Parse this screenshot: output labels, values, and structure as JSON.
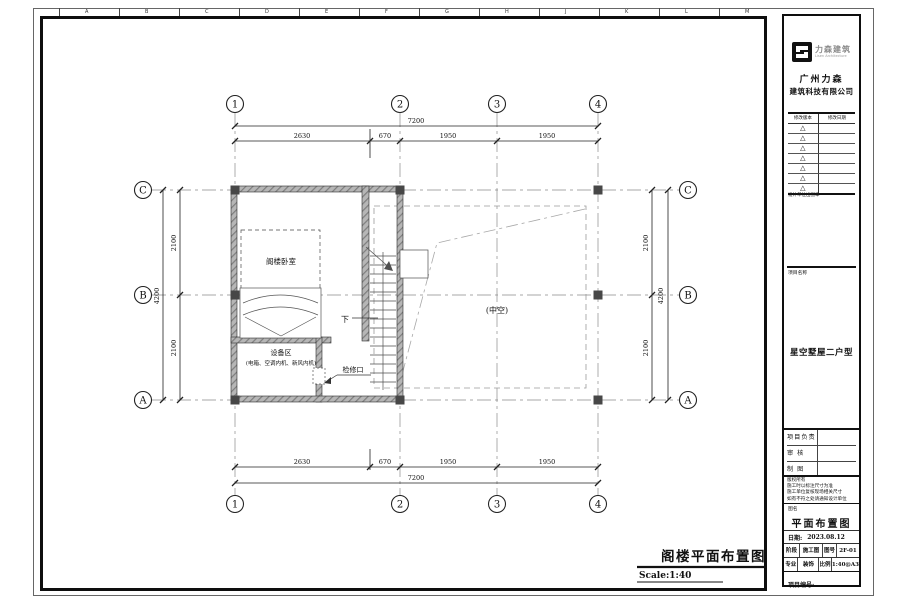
{
  "sheet": {
    "ruler_letters": [
      "A",
      "B",
      "C",
      "D",
      "E",
      "F",
      "G",
      "H",
      "J",
      "K",
      "L",
      "M"
    ],
    "drawing_title": "阁楼平面布置图",
    "drawing_scale": "Scale:1:40"
  },
  "plan": {
    "axes": {
      "cols": [
        "1",
        "2",
        "3",
        "4"
      ],
      "rows": [
        "C",
        "B",
        "A"
      ]
    },
    "dims": {
      "top_total": "7200",
      "top_segments": [
        "2630",
        "670",
        "1950",
        "1950"
      ],
      "bottom_total": "7200",
      "bottom_segments": [
        "2630",
        "670",
        "1950",
        "1950"
      ],
      "left_segments": [
        "2100",
        "2100"
      ],
      "left_total": "4200",
      "right_segments": [
        "2100",
        "2100"
      ],
      "right_total": "4200"
    },
    "labels": {
      "bedroom": "阁楼卧室",
      "equipment_title": "设备区",
      "equipment_detail": "(电箱、空调内机、新风内机)",
      "access": "检修口",
      "void": "(中空)",
      "down": "下"
    }
  },
  "titleblock": {
    "logo_text": "力森建筑",
    "logo_sub": "Lisen Architecture",
    "company_line1": "广州力森",
    "company_line2": "建筑科技有限公司",
    "revision_header_version": "修改版本",
    "revision_header_date": "修改日期",
    "revision_rows": 7,
    "revision_triangle": "△",
    "stamp_label": "设计单位出图章",
    "project_name_label": "项目名称",
    "project_name": "星空墅屋二户型",
    "roles": [
      {
        "label": "项目负责"
      },
      {
        "label": "审  核"
      },
      {
        "label": "制  图"
      }
    ],
    "notes": [
      "版权所有",
      "施工时以标注尺寸为准",
      "施工单位复核现场相关尺寸",
      "如有不符之处请通知设计单位"
    ],
    "drawing_name_label": "图名",
    "drawing_name": "平面布置图",
    "date_label": "日期:",
    "date_value": "2023.08.12",
    "stage_label": "阶段",
    "stage_value": "施工图",
    "sheet_no_label": "图号",
    "sheet_no_value": "2F-01",
    "discipline_label": "专业",
    "discipline_value": "装饰",
    "scale_label": "比例",
    "scale_value": "1:40@A3",
    "project_no_label": "项目编号:"
  }
}
